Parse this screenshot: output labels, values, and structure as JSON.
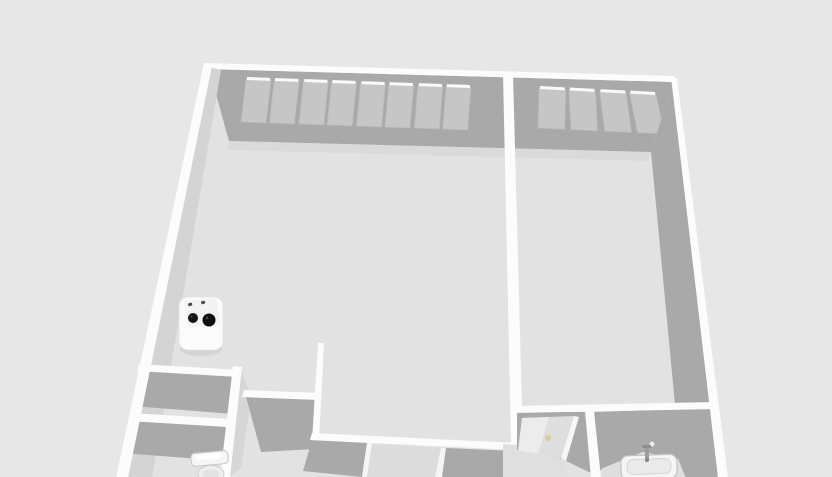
{
  "meta": {
    "view_title": "3D floor plan view",
    "canvas_width": 832,
    "canvas_height": 477
  },
  "palette": {
    "background": "#e7e7e7",
    "floor": "#e2e2e2",
    "floor_dim": "#dedede",
    "wall_face_dark": "#a9a9a9",
    "wall_face_light": "#d4d4d4",
    "wall_top_white": "#fcfcfc",
    "window_pane": "#c6c6c6",
    "sill_highlight": "#fafafa",
    "door_knob": "#d8cf9d"
  },
  "scene": {
    "layers": [
      {
        "kind": "polygon",
        "name": "floor-interior",
        "fill": "#e2e2e2",
        "pts": [
          [
            210,
            68
          ],
          [
            674,
            80
          ],
          [
            723,
            478
          ],
          [
            120,
            478
          ]
        ]
      },
      {
        "kind": "polygon",
        "name": "north-wall-face",
        "fill": "#a9a9a9",
        "pts": [
          [
            209,
            69
          ],
          [
            673,
            82
          ],
          [
            651,
            152
          ],
          [
            229,
            141
          ]
        ]
      },
      {
        "kind": "polygon",
        "name": "north-wall-floor-shadow",
        "fill": "#d6d6d6",
        "opacity": 0.6,
        "pts": [
          [
            229,
            141
          ],
          [
            651,
            152
          ],
          [
            648,
            161
          ],
          [
            228,
            150
          ]
        ]
      },
      {
        "kind": "window-strip",
        "name": "window-strip-left-room",
        "x0": 246,
        "x1": 471,
        "yTop0": 79,
        "yTop1": 87,
        "h": 43,
        "units": 4,
        "panesPerUnit": 2,
        "unitGap": 4,
        "mullion": 3,
        "lean0": -5,
        "lean1": -3,
        "paneFill": "#c6c6c6",
        "paneStroke": "#b8b8b8",
        "sillFill": "#fafafa"
      },
      {
        "kind": "window-strip",
        "name": "window-strip-right-room",
        "x0": 539,
        "x1": 656,
        "yTop0": 88,
        "yTop1": 94,
        "h": 40,
        "units": 2,
        "panesPerUnit": 2,
        "unitGap": 4,
        "mullion": 3,
        "lean0": -1,
        "lean1": 11,
        "paneFill": "#c6c6c6",
        "paneStroke": "#b8b8b8",
        "sillFill": "#fafafa"
      },
      {
        "kind": "polygon",
        "name": "north-wall-top-edge",
        "fill": "#fcfcfc",
        "pts": [
          [
            204,
            63
          ],
          [
            674,
            76
          ],
          [
            674,
            82
          ],
          [
            204,
            69
          ]
        ]
      },
      {
        "kind": "polygon",
        "name": "east-wall-face",
        "fill": "#a9a9a9",
        "pts": [
          [
            673,
            82
          ],
          [
            651,
            152
          ],
          [
            682,
            478
          ],
          [
            724,
            478
          ]
        ]
      },
      {
        "kind": "polygon",
        "name": "room-divider-wall-top",
        "fill": "#fcfcfc",
        "pts": [
          [
            503,
            73
          ],
          [
            513,
            74
          ],
          [
            523,
            444
          ],
          [
            511,
            444
          ]
        ]
      },
      {
        "kind": "polygon",
        "name": "left-wall-inner-face",
        "fill": "#d4d4d4",
        "pts": [
          [
            209,
            67
          ],
          [
            221,
            70
          ],
          [
            152,
            478
          ],
          [
            122,
            478
          ]
        ]
      },
      {
        "kind": "polygon",
        "name": "closet-wall-a-face",
        "fill": "#a9a9a9",
        "pts": [
          [
            140,
            371
          ],
          [
            239,
            377
          ],
          [
            233,
            414
          ],
          [
            132,
            406
          ]
        ]
      },
      {
        "kind": "polygon",
        "name": "closet-wall-a-top-edge",
        "fill": "#fcfcfc",
        "pts": [
          [
            139,
            364
          ],
          [
            240,
            370
          ],
          [
            239,
            377
          ],
          [
            137,
            371
          ]
        ]
      },
      {
        "kind": "polygon",
        "name": "wc-wall-c-face",
        "fill": "#a9a9a9",
        "pts": [
          [
            131,
            421
          ],
          [
            244,
            428
          ],
          [
            238,
            462
          ],
          [
            123,
            453
          ]
        ]
      },
      {
        "kind": "polygon",
        "name": "wc-wall-c-top-edge",
        "fill": "#fcfcfc",
        "pts": [
          [
            131,
            413
          ],
          [
            245,
            420
          ],
          [
            244,
            428
          ],
          [
            129,
            421
          ]
        ]
      },
      {
        "kind": "polygon",
        "name": "wall-b-east-face",
        "fill": "#d6d6d6",
        "pts": [
          [
            241,
            369
          ],
          [
            251,
            397
          ],
          [
            241,
            468
          ],
          [
            229,
            477
          ]
        ]
      },
      {
        "kind": "polygon",
        "name": "wall-b-top-edge",
        "fill": "#fcfcfc",
        "pts": [
          [
            233,
            366
          ],
          [
            242,
            367
          ],
          [
            230,
            478
          ],
          [
            220,
            478
          ]
        ]
      },
      {
        "kind": "polygon",
        "name": "hall-wall-d-face",
        "fill": "#a9a9a9",
        "pts": [
          [
            246,
            397
          ],
          [
            320,
            400
          ],
          [
            314,
            449
          ],
          [
            261,
            452
          ]
        ]
      },
      {
        "kind": "polygon",
        "name": "hall-wall-d-top-edge",
        "fill": "#fcfcfc",
        "pts": [
          [
            244,
            390
          ],
          [
            321,
            393
          ],
          [
            320,
            400
          ],
          [
            242,
            397
          ]
        ]
      },
      {
        "kind": "polygon",
        "name": "stub-wall-top-edge",
        "fill": "#fcfcfc",
        "pts": [
          [
            318,
            343
          ],
          [
            324,
            343
          ],
          [
            319,
            441
          ],
          [
            312,
            441
          ]
        ]
      },
      {
        "kind": "polygon",
        "name": "south-wall-face-left",
        "fill": "#a9a9a9",
        "pts": [
          [
            312,
            440
          ],
          [
            367,
            443
          ],
          [
            362,
            477
          ],
          [
            303,
            471
          ]
        ]
      },
      {
        "kind": "polygon",
        "name": "doorway-jamb-left",
        "fill": "#f5f5f5",
        "pts": [
          [
            367,
            443
          ],
          [
            372,
            443
          ],
          [
            367,
            477
          ],
          [
            362,
            477
          ]
        ]
      },
      {
        "kind": "polygon",
        "name": "doorway-opening-floor",
        "fill": "#dcdcdc",
        "pts": [
          [
            372,
            444
          ],
          [
            441,
            448
          ],
          [
            435,
            477
          ],
          [
            367,
            477
          ]
        ]
      },
      {
        "kind": "polygon",
        "name": "doorway-jamb-right",
        "fill": "#f5f5f5",
        "pts": [
          [
            441,
            448
          ],
          [
            446,
            448
          ],
          [
            442,
            477
          ],
          [
            435,
            477
          ]
        ]
      },
      {
        "kind": "polygon",
        "name": "south-wall-face-right",
        "fill": "#a9a9a9",
        "pts": [
          [
            446,
            448
          ],
          [
            516,
            451
          ],
          [
            514,
            477
          ],
          [
            442,
            477
          ]
        ]
      },
      {
        "kind": "polygon",
        "name": "south-wall-top-edge",
        "fill": "#fcfcfc",
        "pts": [
          [
            312,
            433
          ],
          [
            517,
            443
          ],
          [
            516,
            450
          ],
          [
            310,
            440
          ]
        ]
      },
      {
        "kind": "polygon",
        "name": "door-room-wall-face",
        "fill": "#a9a9a9",
        "pts": [
          [
            517,
            412
          ],
          [
            595,
            412
          ],
          [
            595,
            475
          ],
          [
            560,
            458
          ],
          [
            517,
            450
          ]
        ]
      },
      {
        "kind": "polygon",
        "name": "bathroom-wall-face",
        "fill": "#a9a9a9",
        "pts": [
          [
            595,
            412
          ],
          [
            716,
            408
          ],
          [
            722,
            478
          ],
          [
            686,
            478
          ],
          [
            678,
            459
          ],
          [
            643,
            452
          ],
          [
            603,
            468
          ],
          [
            595,
            475
          ]
        ]
      },
      {
        "kind": "polygon",
        "name": "bathroom-wall-top-edge",
        "fill": "#fcfcfc",
        "pts": [
          [
            513,
            406
          ],
          [
            716,
            402
          ],
          [
            716,
            409
          ],
          [
            513,
            413
          ]
        ]
      },
      {
        "kind": "polygon",
        "name": "door-leaf",
        "fill": "#dedede",
        "pts": [
          [
            522,
            418
          ],
          [
            574,
            416
          ],
          [
            561,
            458
          ],
          [
            518,
            451
          ]
        ]
      },
      {
        "kind": "polygon",
        "name": "door-leaf-highlight",
        "fill": "#ececec",
        "pts": [
          [
            522,
            418
          ],
          [
            549,
            417
          ],
          [
            538,
            454
          ],
          [
            518,
            451
          ]
        ]
      },
      {
        "kind": "polygon",
        "name": "door-leaf-edge",
        "fill": "#f7f7f7",
        "pts": [
          [
            574,
            416
          ],
          [
            579,
            417
          ],
          [
            566,
            461
          ],
          [
            561,
            458
          ]
        ]
      },
      {
        "kind": "circle",
        "name": "door-knob",
        "fill": "#d8cf9d",
        "cx": 548,
        "cy": 438,
        "r": 3
      },
      {
        "kind": "polygon",
        "name": "door-room-floor",
        "fill": "#dfdfdf",
        "pts": [
          [
            503,
            444
          ],
          [
            517,
            445
          ],
          [
            517,
            450
          ],
          [
            560,
            458
          ],
          [
            568,
            478
          ],
          [
            503,
            478
          ]
        ]
      },
      {
        "kind": "polygon",
        "name": "bathroom-divider-wall-top",
        "fill": "#fcfcfc",
        "pts": [
          [
            585,
            411
          ],
          [
            594,
            411
          ],
          [
            601,
            478
          ],
          [
            591,
            478
          ]
        ]
      },
      {
        "kind": "polygon",
        "name": "bathroom-floor",
        "fill": "#dedede",
        "pts": [
          [
            603,
            468
          ],
          [
            643,
            452
          ],
          [
            678,
            459
          ],
          [
            686,
            478
          ],
          [
            603,
            478
          ]
        ]
      },
      {
        "kind": "circle",
        "name": "bathroom-wall-dot",
        "fill": "#f0f0f0",
        "cx": 652,
        "cy": 444,
        "r": 2.4
      },
      {
        "kind": "rect",
        "name": "sink-basin",
        "fill": "#f5f5f5",
        "stroke": "#c2c2c2",
        "sw": 1.2,
        "x": 621,
        "y": 455,
        "w": 56,
        "h": 24,
        "rx": 7,
        "transform": "rotate(-2 649 467)"
      },
      {
        "kind": "rect",
        "name": "sink-basin-inner",
        "fill": "#eaeaea",
        "stroke": "#d6d6d6",
        "sw": 1,
        "x": 627,
        "y": 459,
        "w": 44,
        "h": 15,
        "rx": 6,
        "transform": "rotate(-2 649 467)"
      },
      {
        "kind": "rect",
        "name": "sink-faucet-stem",
        "fill": "#9c9c9c",
        "x": 645,
        "y": 446,
        "w": 4,
        "h": 13,
        "rx": 1
      },
      {
        "kind": "rect",
        "name": "sink-faucet-spout",
        "fill": "#8e8e8e",
        "x": 642,
        "y": 445,
        "w": 9,
        "h": 3,
        "rx": 1
      },
      {
        "kind": "circle",
        "name": "sink-drain",
        "fill": "#8a8a8a",
        "cx": 647,
        "cy": 460,
        "r": 2.2
      },
      {
        "kind": "polygon",
        "name": "east-wall-top-edge",
        "fill": "#fcfcfc",
        "pts": [
          [
            671,
            77
          ],
          [
            677,
            78
          ],
          [
            728,
            478
          ],
          [
            718,
            478
          ]
        ]
      },
      {
        "kind": "polygon",
        "name": "left-wall-top-edge",
        "fill": "#fcfcfc",
        "pts": [
          [
            204,
            63
          ],
          [
            212,
            66
          ],
          [
            128,
            478
          ],
          [
            116,
            478
          ]
        ]
      },
      {
        "kind": "rect",
        "name": "toilet-tank",
        "fill": "#f6f6f6",
        "stroke": "#c6c6c6",
        "sw": 1,
        "x": 191,
        "y": 452,
        "w": 37,
        "h": 13,
        "rx": 4,
        "transform": "rotate(-5 209 458)"
      },
      {
        "kind": "rect",
        "name": "toilet-tank-lid-highlight",
        "fill": "#ffffff",
        "x": 196,
        "y": 454,
        "w": 26,
        "h": 5,
        "rx": 2,
        "transform": "rotate(-5 209 458)"
      },
      {
        "kind": "ellipse",
        "name": "toilet-bowl",
        "fill": "#efefef",
        "stroke": "#cdcdcd",
        "sw": 1,
        "cx": 211,
        "cy": 474,
        "rx": 13,
        "ry": 8.5
      },
      {
        "kind": "ellipse",
        "name": "toilet-bowl-inner",
        "fill": "#e3e3e3",
        "cx": 211,
        "cy": 474,
        "rx": 8.5,
        "ry": 5
      },
      {
        "kind": "ellipse",
        "name": "stove-shadow",
        "fill": "#d4d4d4",
        "cx": 201,
        "cy": 349,
        "rx": 21,
        "ry": 7
      },
      {
        "kind": "rect",
        "name": "stove-body",
        "fill": "#fbfbfb",
        "stroke": "#e2e2e2",
        "sw": 0.8,
        "x": 179,
        "y": 297,
        "w": 44,
        "h": 53,
        "rx": 9
      },
      {
        "kind": "polygon",
        "name": "stove-top-face",
        "fill": "#f3f3f3",
        "pts": [
          [
            184,
            301
          ],
          [
            216,
            298
          ],
          [
            221,
            324
          ],
          [
            188,
            328
          ]
        ]
      },
      {
        "kind": "rect",
        "name": "stove-knob-left",
        "fill": "#4a4a4a",
        "x": 188,
        "y": 303,
        "w": 4,
        "h": 3,
        "rx": 1,
        "transform": "rotate(-20 190 304)"
      },
      {
        "kind": "rect",
        "name": "stove-knob-right",
        "fill": "#4a4a4a",
        "x": 201,
        "y": 301,
        "w": 4,
        "h": 3,
        "rx": 1,
        "transform": "rotate(-15 203 302)"
      },
      {
        "kind": "circle",
        "name": "stove-burner-small",
        "fill": "#141414",
        "cx": 193,
        "cy": 318,
        "r": 5
      },
      {
        "kind": "circle",
        "name": "stove-burner-large",
        "fill": "#0e0e0e",
        "cx": 209,
        "cy": 320,
        "r": 6.5
      },
      {
        "kind": "circle",
        "name": "stove-burner-small-glint",
        "fill": "#4d4d4d",
        "cx": 191.5,
        "cy": 316.5,
        "r": 1.1
      },
      {
        "kind": "circle",
        "name": "stove-burner-large-glint",
        "fill": "#444444",
        "cx": 207,
        "cy": 318,
        "r": 1.3
      }
    ]
  }
}
